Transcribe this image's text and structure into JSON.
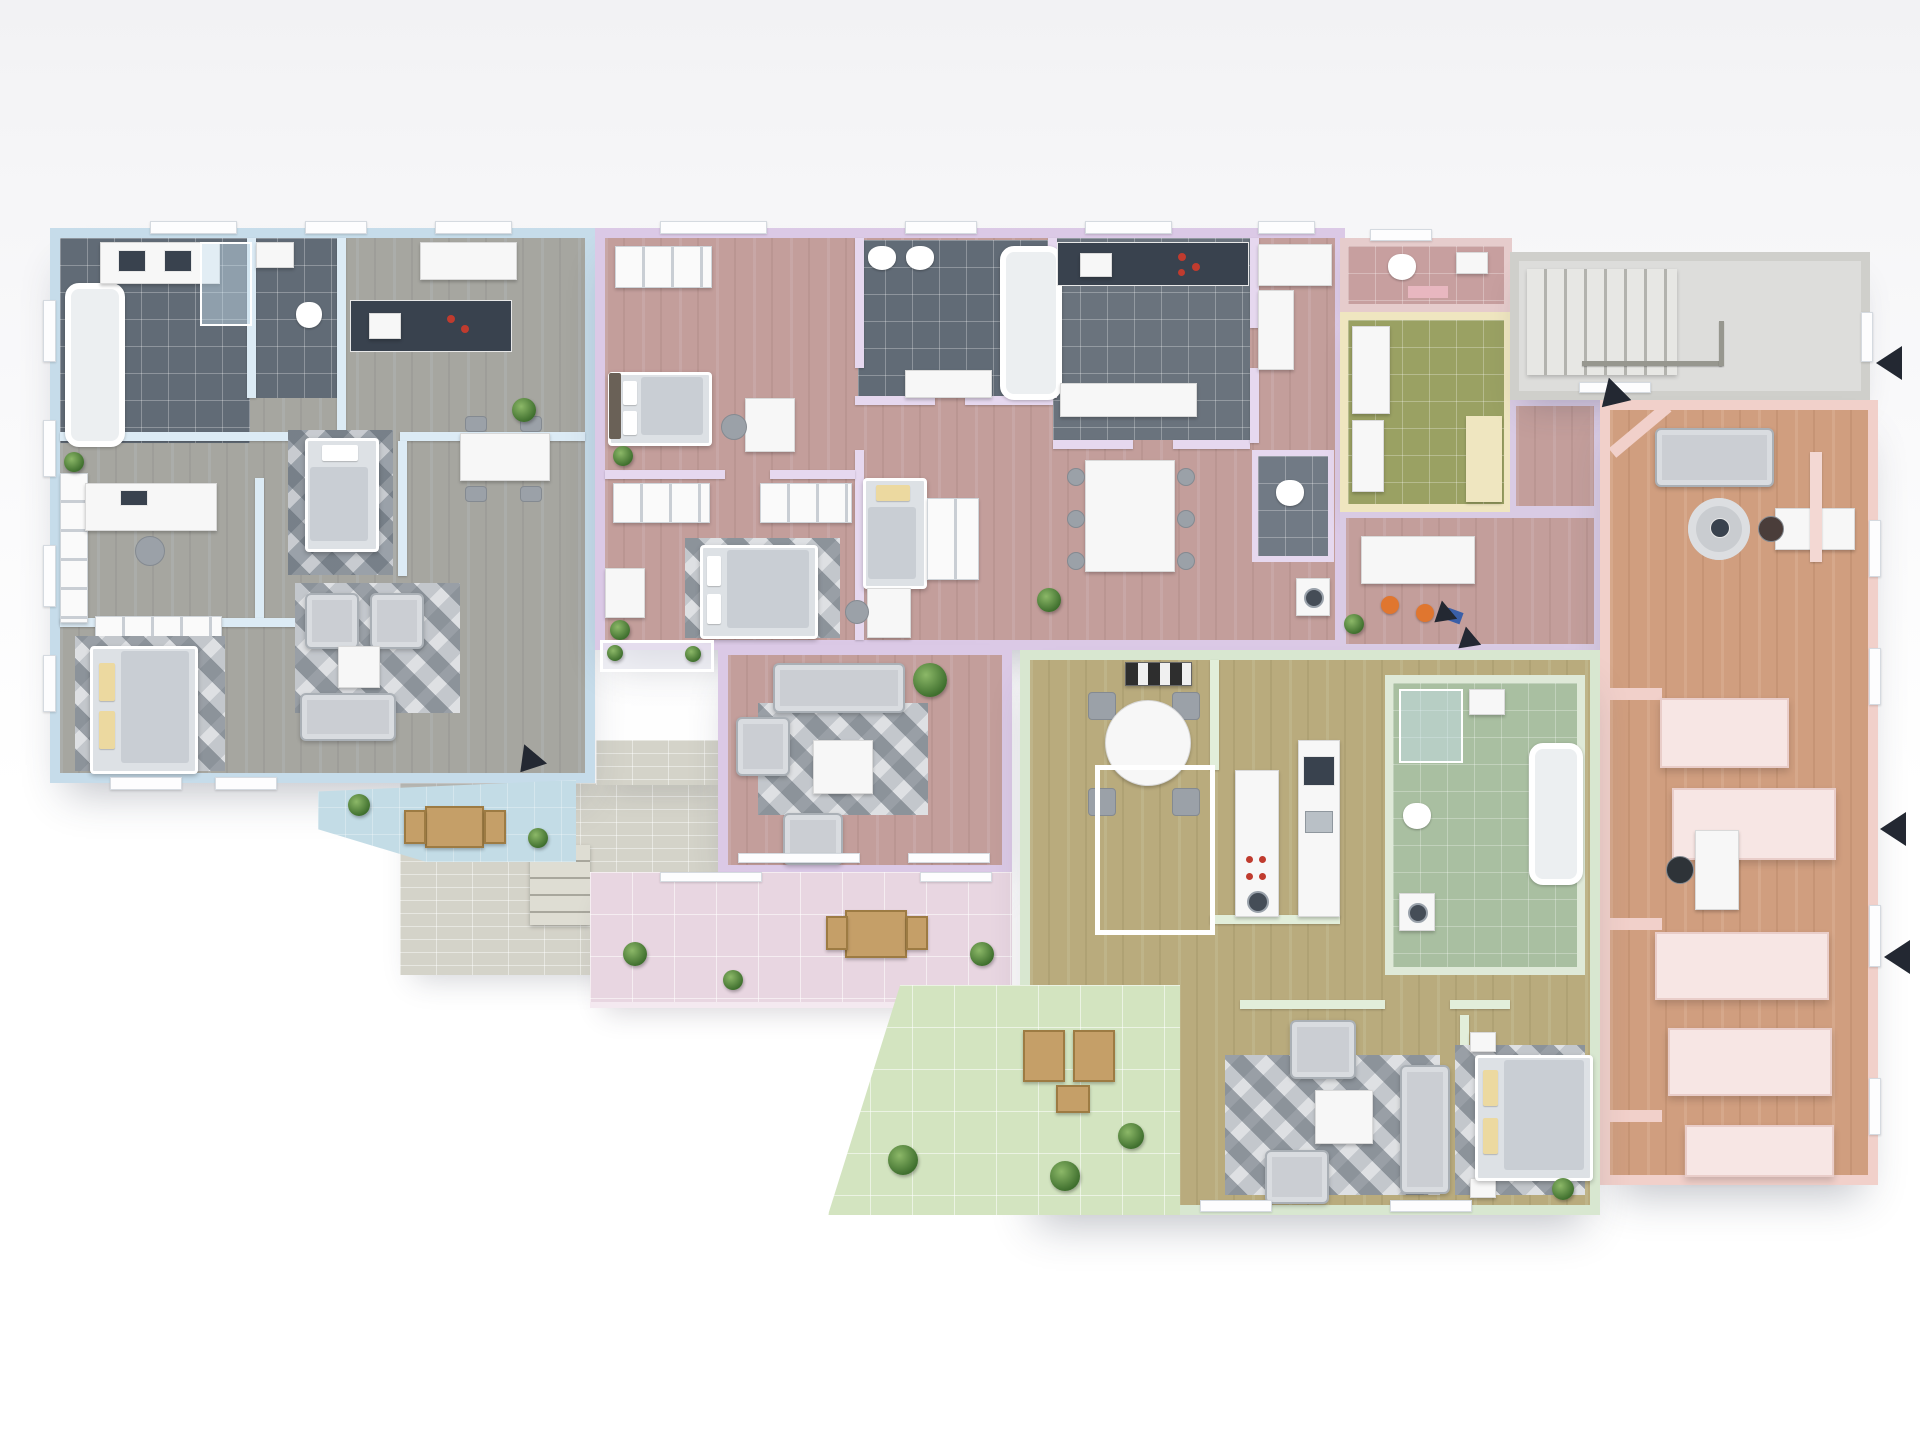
{
  "scene": {
    "kind": "3d-floor-plan-render",
    "view": "top-down-isometric",
    "floor": "multi-unit-residential-level",
    "visible_text": ""
  },
  "colors": {
    "bg_top": "#f2f2f4",
    "bg": "#ffffff",
    "wood": "#c9a584",
    "blue_wall": "#c6dcea",
    "blue_tint": "rgba(120,168,200,0.42)",
    "blue_tile": "#5e7180",
    "balcony_blue": "#c3dce6",
    "purple_wall": "#dbc9e6",
    "purple_tint": "rgba(186,148,198,0.34)",
    "dark_tile": "#616b76",
    "green_wall": "#d8e7d0",
    "green_tint": "rgba(148,186,108,0.30)",
    "sage_tile": "#a9bfa1",
    "green_terrace": "#d3e4c0",
    "salmon_wall": "#f1d0ca",
    "salmon_tint": "rgba(232,140,112,0.25)",
    "salmon_block": "#f7e6e4",
    "yellow_wall": "#efe6c0",
    "olive_tile": "#9aa163",
    "rose_tile": "#c79f9f",
    "pink_terrace": "#e8d6e1",
    "patio": "#d4d3c9",
    "gray_wall": "#cfcfcb",
    "stair_floor": "#dddddb",
    "rug": "#c3c7cc",
    "rug_dark": "#9aa1a9",
    "arrow": "#232832"
  },
  "units": [
    {
      "id": "unit-blue",
      "tint": "blue",
      "rooms": [
        "bathroom",
        "wc",
        "kitchen",
        "home-office",
        "bedroom",
        "living-dining-room",
        "master-bedroom",
        "balcony"
      ]
    },
    {
      "id": "unit-purple",
      "tint": "purple",
      "rooms": [
        "bedroom",
        "kids-room",
        "bathroom",
        "kitchen",
        "dining-area",
        "living-room",
        "wc",
        "utility",
        "terrace"
      ]
    },
    {
      "id": "unit-green",
      "tint": "green",
      "rooms": [
        "kitchen-dining",
        "bathroom",
        "hallway",
        "living-room",
        "bedroom",
        "terrace"
      ]
    },
    {
      "id": "unit-salmon",
      "tint": "salmon",
      "rooms": [
        "lounge",
        "office",
        "storage"
      ]
    },
    {
      "id": "bathroom-yellow",
      "tint": "yellow",
      "rooms": [
        "wc",
        "shower-bath"
      ]
    },
    {
      "id": "common-areas",
      "tint": "gray",
      "rooms": [
        "staircase-hall",
        "corridor",
        "patio"
      ]
    }
  ],
  "markers": {
    "entrance_arrows": 7,
    "arrow_color": "#232832"
  }
}
